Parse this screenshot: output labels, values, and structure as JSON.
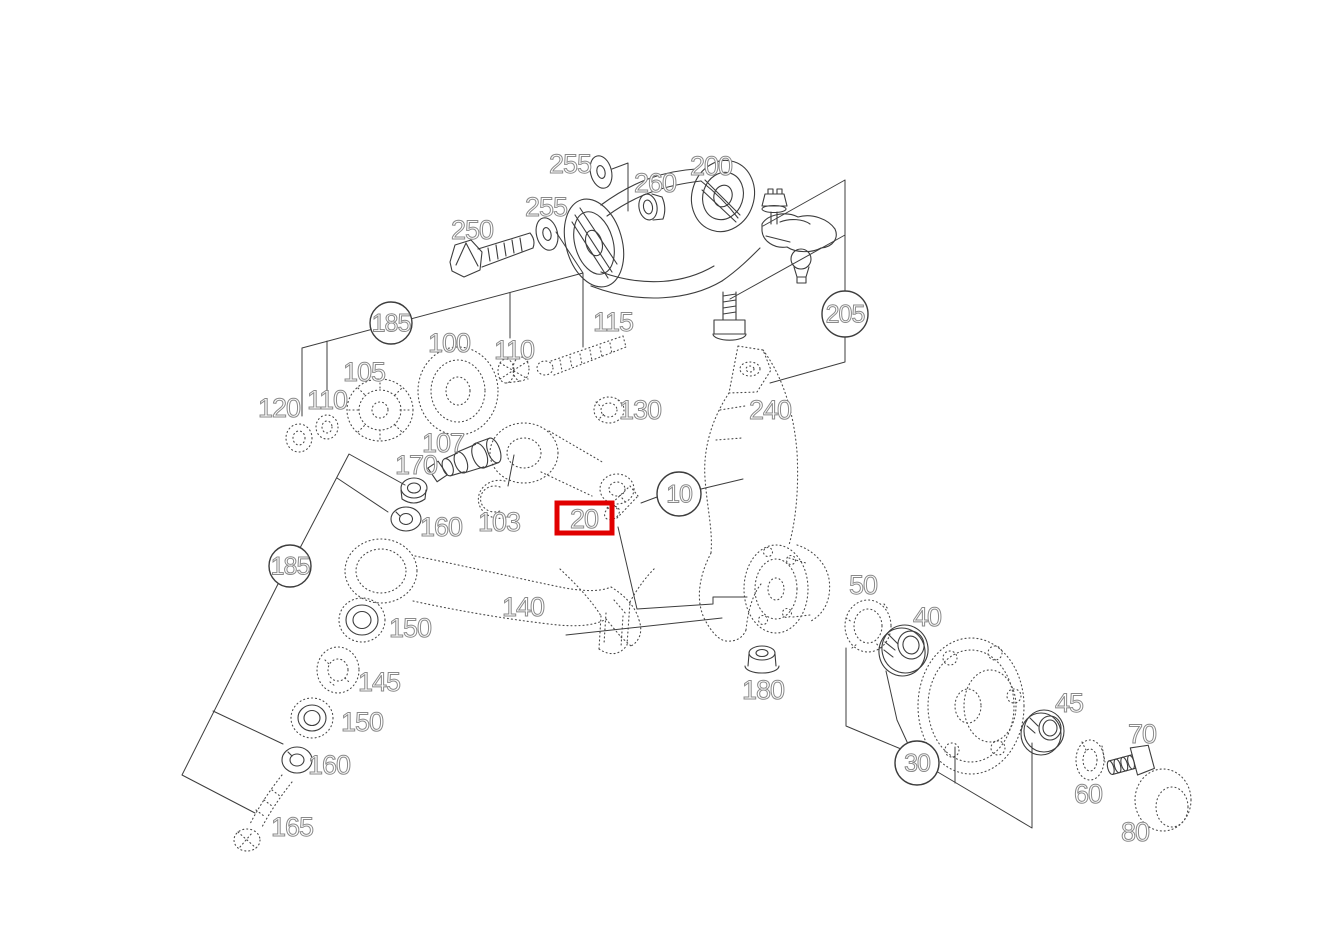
{
  "diagram": {
    "kind": "exploded-parts-diagram",
    "background_color": "#ffffff",
    "line_color": "#3d3d3d",
    "label_outline_color": "#8a8a8a",
    "highlight_box_color": "#e10000",
    "part_labels": [
      {
        "text": "255",
        "x": 570,
        "y": 164
      },
      {
        "text": "260",
        "x": 655,
        "y": 183
      },
      {
        "text": "200",
        "x": 711,
        "y": 166
      },
      {
        "text": "255",
        "x": 546,
        "y": 207
      },
      {
        "text": "250",
        "x": 472,
        "y": 230
      },
      {
        "text": "115",
        "x": 613,
        "y": 322
      },
      {
        "text": "100",
        "x": 449,
        "y": 343
      },
      {
        "text": "110",
        "x": 514,
        "y": 350
      },
      {
        "text": "105",
        "x": 364,
        "y": 372
      },
      {
        "text": "110",
        "x": 327,
        "y": 400
      },
      {
        "text": "120",
        "x": 279,
        "y": 408
      },
      {
        "text": "130",
        "x": 640,
        "y": 410
      },
      {
        "text": "240",
        "x": 770,
        "y": 410
      },
      {
        "text": "107",
        "x": 443,
        "y": 443
      },
      {
        "text": "170",
        "x": 416,
        "y": 465
      },
      {
        "text": "160",
        "x": 441,
        "y": 527
      },
      {
        "text": "103",
        "x": 499,
        "y": 522
      },
      {
        "text": "140",
        "x": 523,
        "y": 607
      },
      {
        "text": "150",
        "x": 410,
        "y": 628
      },
      {
        "text": "145",
        "x": 379,
        "y": 682
      },
      {
        "text": "150",
        "x": 362,
        "y": 722
      },
      {
        "text": "160",
        "x": 329,
        "y": 765
      },
      {
        "text": "165",
        "x": 292,
        "y": 827
      },
      {
        "text": "180",
        "x": 763,
        "y": 690
      },
      {
        "text": "50",
        "x": 863,
        "y": 585
      },
      {
        "text": "40",
        "x": 927,
        "y": 617
      },
      {
        "text": "45",
        "x": 1069,
        "y": 703
      },
      {
        "text": "70",
        "x": 1142,
        "y": 734
      },
      {
        "text": "60",
        "x": 1088,
        "y": 794
      },
      {
        "text": "80",
        "x": 1135,
        "y": 832
      }
    ],
    "circled_labels": [
      {
        "text": "185",
        "x": 391,
        "y": 323,
        "r": 21
      },
      {
        "text": "185",
        "x": 290,
        "y": 566,
        "r": 21
      },
      {
        "text": "205",
        "x": 845,
        "y": 314,
        "r": 23
      },
      {
        "text": "10",
        "x": 679,
        "y": 494,
        "r": 22
      },
      {
        "text": "30",
        "x": 917,
        "y": 763,
        "r": 22
      }
    ],
    "highlighted_label": {
      "text": "20",
      "x": 584,
      "y": 519,
      "box": {
        "x": 557,
        "y": 503,
        "w": 55,
        "h": 30,
        "stroke_width": 5
      }
    }
  }
}
